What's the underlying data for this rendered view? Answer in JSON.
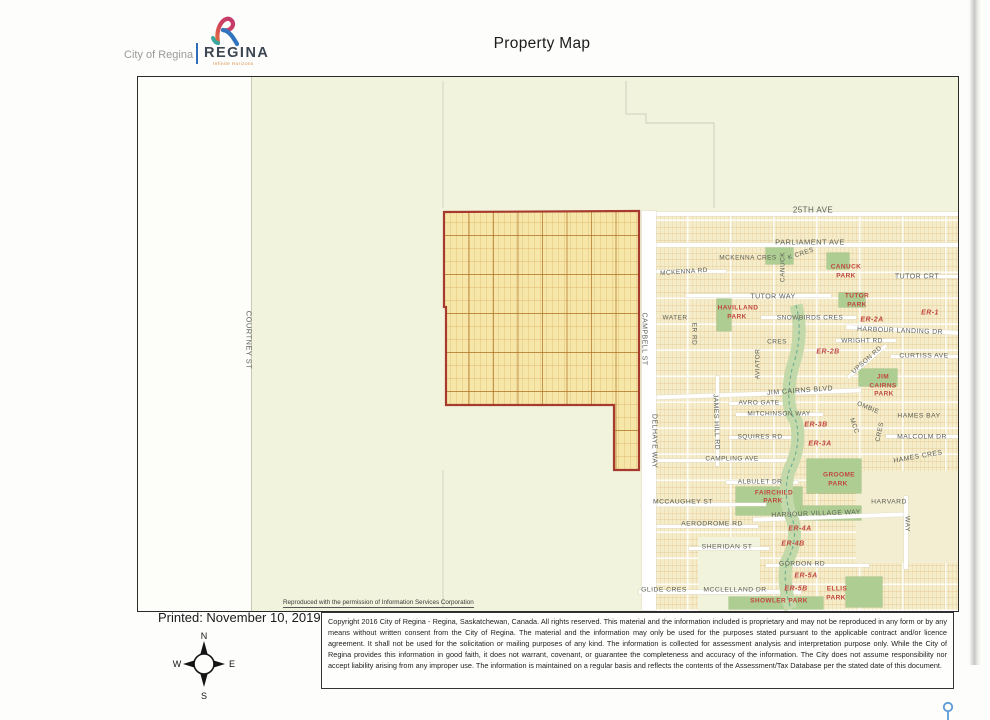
{
  "header": {
    "dept": "City of Regina",
    "brand": "REGINA",
    "tagline": "Infinite Horizons",
    "title": "Property Map"
  },
  "map": {
    "attribution": "Reproduced with the permission of Information Services Corporation",
    "street_labels": [
      {
        "t": "25TH AVE",
        "x": 813,
        "y": 210,
        "r": 0,
        "s": 8
      },
      {
        "t": "PARLIAMENT AVE",
        "x": 810,
        "y": 242,
        "r": 0,
        "s": 7.5
      },
      {
        "t": "MCKENNA CRES",
        "x": 748,
        "y": 258,
        "r": 0,
        "s": 6.5
      },
      {
        "t": "K CRES",
        "x": 801,
        "y": 254,
        "r": -18,
        "s": 6.5
      },
      {
        "t": "CANUCK",
        "x": 783,
        "y": 267,
        "r": -90,
        "s": 6.5
      },
      {
        "t": "MCKENNA RD",
        "x": 684,
        "y": 272,
        "r": -4,
        "s": 6.5
      },
      {
        "t": "TUTOR CRT",
        "x": 917,
        "y": 277,
        "r": 0,
        "s": 7
      },
      {
        "t": "TUTOR WAY",
        "x": 773,
        "y": 297,
        "r": 0,
        "s": 7
      },
      {
        "t": "WATER",
        "x": 675,
        "y": 318,
        "r": 0,
        "s": 6.5
      },
      {
        "t": "ER RD",
        "x": 694,
        "y": 334,
        "r": 90,
        "s": 6.5
      },
      {
        "t": "SNOWBIRDS CRES",
        "x": 810,
        "y": 318,
        "r": 0,
        "s": 6.5
      },
      {
        "t": "HARBOUR LANDING DR",
        "x": 900,
        "y": 331,
        "r": 2,
        "s": 6.8
      },
      {
        "t": "WRIGHT RD",
        "x": 862,
        "y": 341,
        "r": 0,
        "s": 6.5
      },
      {
        "t": "CRES",
        "x": 777,
        "y": 342,
        "r": 0,
        "s": 6.5
      },
      {
        "t": "AVIATOR",
        "x": 758,
        "y": 364,
        "r": -90,
        "s": 6.5
      },
      {
        "t": "UPSON RD",
        "x": 867,
        "y": 360,
        "r": -42,
        "s": 6.5
      },
      {
        "t": "CURTISS AVE",
        "x": 924,
        "y": 356,
        "r": 0,
        "s": 6.8
      },
      {
        "t": "JIM CAIRNS BLVD",
        "x": 800,
        "y": 391,
        "r": -4,
        "s": 7
      },
      {
        "t": "AVRO GATE",
        "x": 759,
        "y": 403,
        "r": 0,
        "s": 6.5
      },
      {
        "t": "MITCHINSON WAY",
        "x": 779,
        "y": 414,
        "r": 0,
        "s": 6.5
      },
      {
        "t": "OMBIE",
        "x": 868,
        "y": 408,
        "r": 22,
        "s": 6.5
      },
      {
        "t": "MCC",
        "x": 854,
        "y": 426,
        "r": 70,
        "s": 6.5
      },
      {
        "t": "CRES",
        "x": 880,
        "y": 432,
        "r": -78,
        "s": 6.5
      },
      {
        "t": "HAMES BAY",
        "x": 919,
        "y": 416,
        "r": 0,
        "s": 6.8
      },
      {
        "t": "SQUIRES RD",
        "x": 760,
        "y": 437,
        "r": 0,
        "s": 6.5
      },
      {
        "t": "MALCOLM DR",
        "x": 922,
        "y": 437,
        "r": 0,
        "s": 6.8
      },
      {
        "t": "CAMPLING AVE",
        "x": 732,
        "y": 459,
        "r": 0,
        "s": 6.5
      },
      {
        "t": "HAMES CRES",
        "x": 918,
        "y": 457,
        "r": -10,
        "s": 6.8
      },
      {
        "t": "ALBULET DR",
        "x": 760,
        "y": 482,
        "r": 0,
        "s": 6.5
      },
      {
        "t": "MCCAUGHEY ST",
        "x": 683,
        "y": 502,
        "r": 0,
        "s": 6.8
      },
      {
        "t": "HARVARD",
        "x": 889,
        "y": 502,
        "r": 0,
        "s": 6.8
      },
      {
        "t": "WAY",
        "x": 907,
        "y": 524,
        "r": 90,
        "s": 6.8
      },
      {
        "t": "HARBOUR VILLAGE WAY",
        "x": 816,
        "y": 514,
        "r": -2,
        "s": 6.8
      },
      {
        "t": "AERODROME RD",
        "x": 712,
        "y": 524,
        "r": 0,
        "s": 6.8
      },
      {
        "t": "SHERIDAN ST",
        "x": 727,
        "y": 547,
        "r": 0,
        "s": 6.8
      },
      {
        "t": "GORDON RD",
        "x": 802,
        "y": 564,
        "r": 0,
        "s": 6.8
      },
      {
        "t": "GLIDE CRES",
        "x": 664,
        "y": 590,
        "r": 0,
        "s": 6.8
      },
      {
        "t": "MCCLELLAND DR",
        "x": 735,
        "y": 590,
        "r": 0,
        "s": 6.8
      },
      {
        "t": "COURTNEY ST",
        "x": 249,
        "y": 340,
        "r": 90,
        "s": 7.5
      },
      {
        "t": "CAMPBELL ST",
        "x": 644,
        "y": 339,
        "r": 90,
        "s": 7
      },
      {
        "t": "DELHAYE WAY",
        "x": 654,
        "y": 441,
        "r": 90,
        "s": 7
      },
      {
        "t": "JAMES HILL RD",
        "x": 716,
        "y": 422,
        "r": 88,
        "s": 6.8
      }
    ],
    "park_labels": [
      {
        "t": "CANUCK",
        "x": 846,
        "y": 267
      },
      {
        "t": "PARK",
        "x": 846,
        "y": 276
      },
      {
        "t": "TUTOR",
        "x": 857,
        "y": 296
      },
      {
        "t": "PARK",
        "x": 857,
        "y": 305
      },
      {
        "t": "HAVILLAND",
        "x": 738,
        "y": 308
      },
      {
        "t": "PARK",
        "x": 737,
        "y": 317
      },
      {
        "t": "JIM",
        "x": 883,
        "y": 377
      },
      {
        "t": "CAIRNS",
        "x": 883,
        "y": 386
      },
      {
        "t": "PARK",
        "x": 884,
        "y": 394
      },
      {
        "t": "GROOME",
        "x": 839,
        "y": 475
      },
      {
        "t": "PARK",
        "x": 838,
        "y": 484
      },
      {
        "t": "FAIRCHILD",
        "x": 774,
        "y": 493
      },
      {
        "t": "PARK",
        "x": 773,
        "y": 501
      },
      {
        "t": "ELLIS",
        "x": 837,
        "y": 589
      },
      {
        "t": "PARK",
        "x": 836,
        "y": 598
      },
      {
        "t": "SHOWLER PARK",
        "x": 779,
        "y": 601
      }
    ],
    "er_labels": [
      {
        "t": "ER-1",
        "x": 930,
        "y": 313
      },
      {
        "t": "ER-2A",
        "x": 872,
        "y": 320
      },
      {
        "t": "ER-2B",
        "x": 828,
        "y": 352
      },
      {
        "t": "ER-3B",
        "x": 816,
        "y": 425
      },
      {
        "t": "ER-3A",
        "x": 820,
        "y": 444
      },
      {
        "t": "ER-4A",
        "x": 800,
        "y": 529
      },
      {
        "t": "ER-4B",
        "x": 793,
        "y": 544
      },
      {
        "t": "ER-5A",
        "x": 806,
        "y": 576
      },
      {
        "t": "ER-5B",
        "x": 796,
        "y": 589
      }
    ]
  },
  "footer": {
    "printed": "Printed: November 10, 2019",
    "compass": {
      "n": "N",
      "e": "E",
      "s": "S",
      "w": "W"
    },
    "copyright": "Copyright 2016 City of Regina - Regina, Saskatchewan, Canada. All rights reserved. This material and the information included is proprietary and may not be reproduced in any form or by any means without written consent from the City of Regina. The material and the information may only be used for the purposes stated pursuant to the applicable contract and/or licence agreement. It shall not be used for the solicitation or mailing purposes of any kind. The information is collected for assessment analysis and interpretation purpose only. While the City of Regina provides this information in good faith, it does not warrant, covenant, or guarantee the completeness and accuracy of the information. The City does not assume responsibility nor accept liability arising from any improper use. The information is maintained on a regular basis and reflects the contents of the Assessment/Tax Database per the stated date of this document."
  },
  "colors": {
    "parcel_outline": "#a63a2e",
    "parcel_fill": "#f6e7a9",
    "park_green": "#aecd92",
    "label_red": "#c0473e",
    "land": "#f2f3dc"
  }
}
